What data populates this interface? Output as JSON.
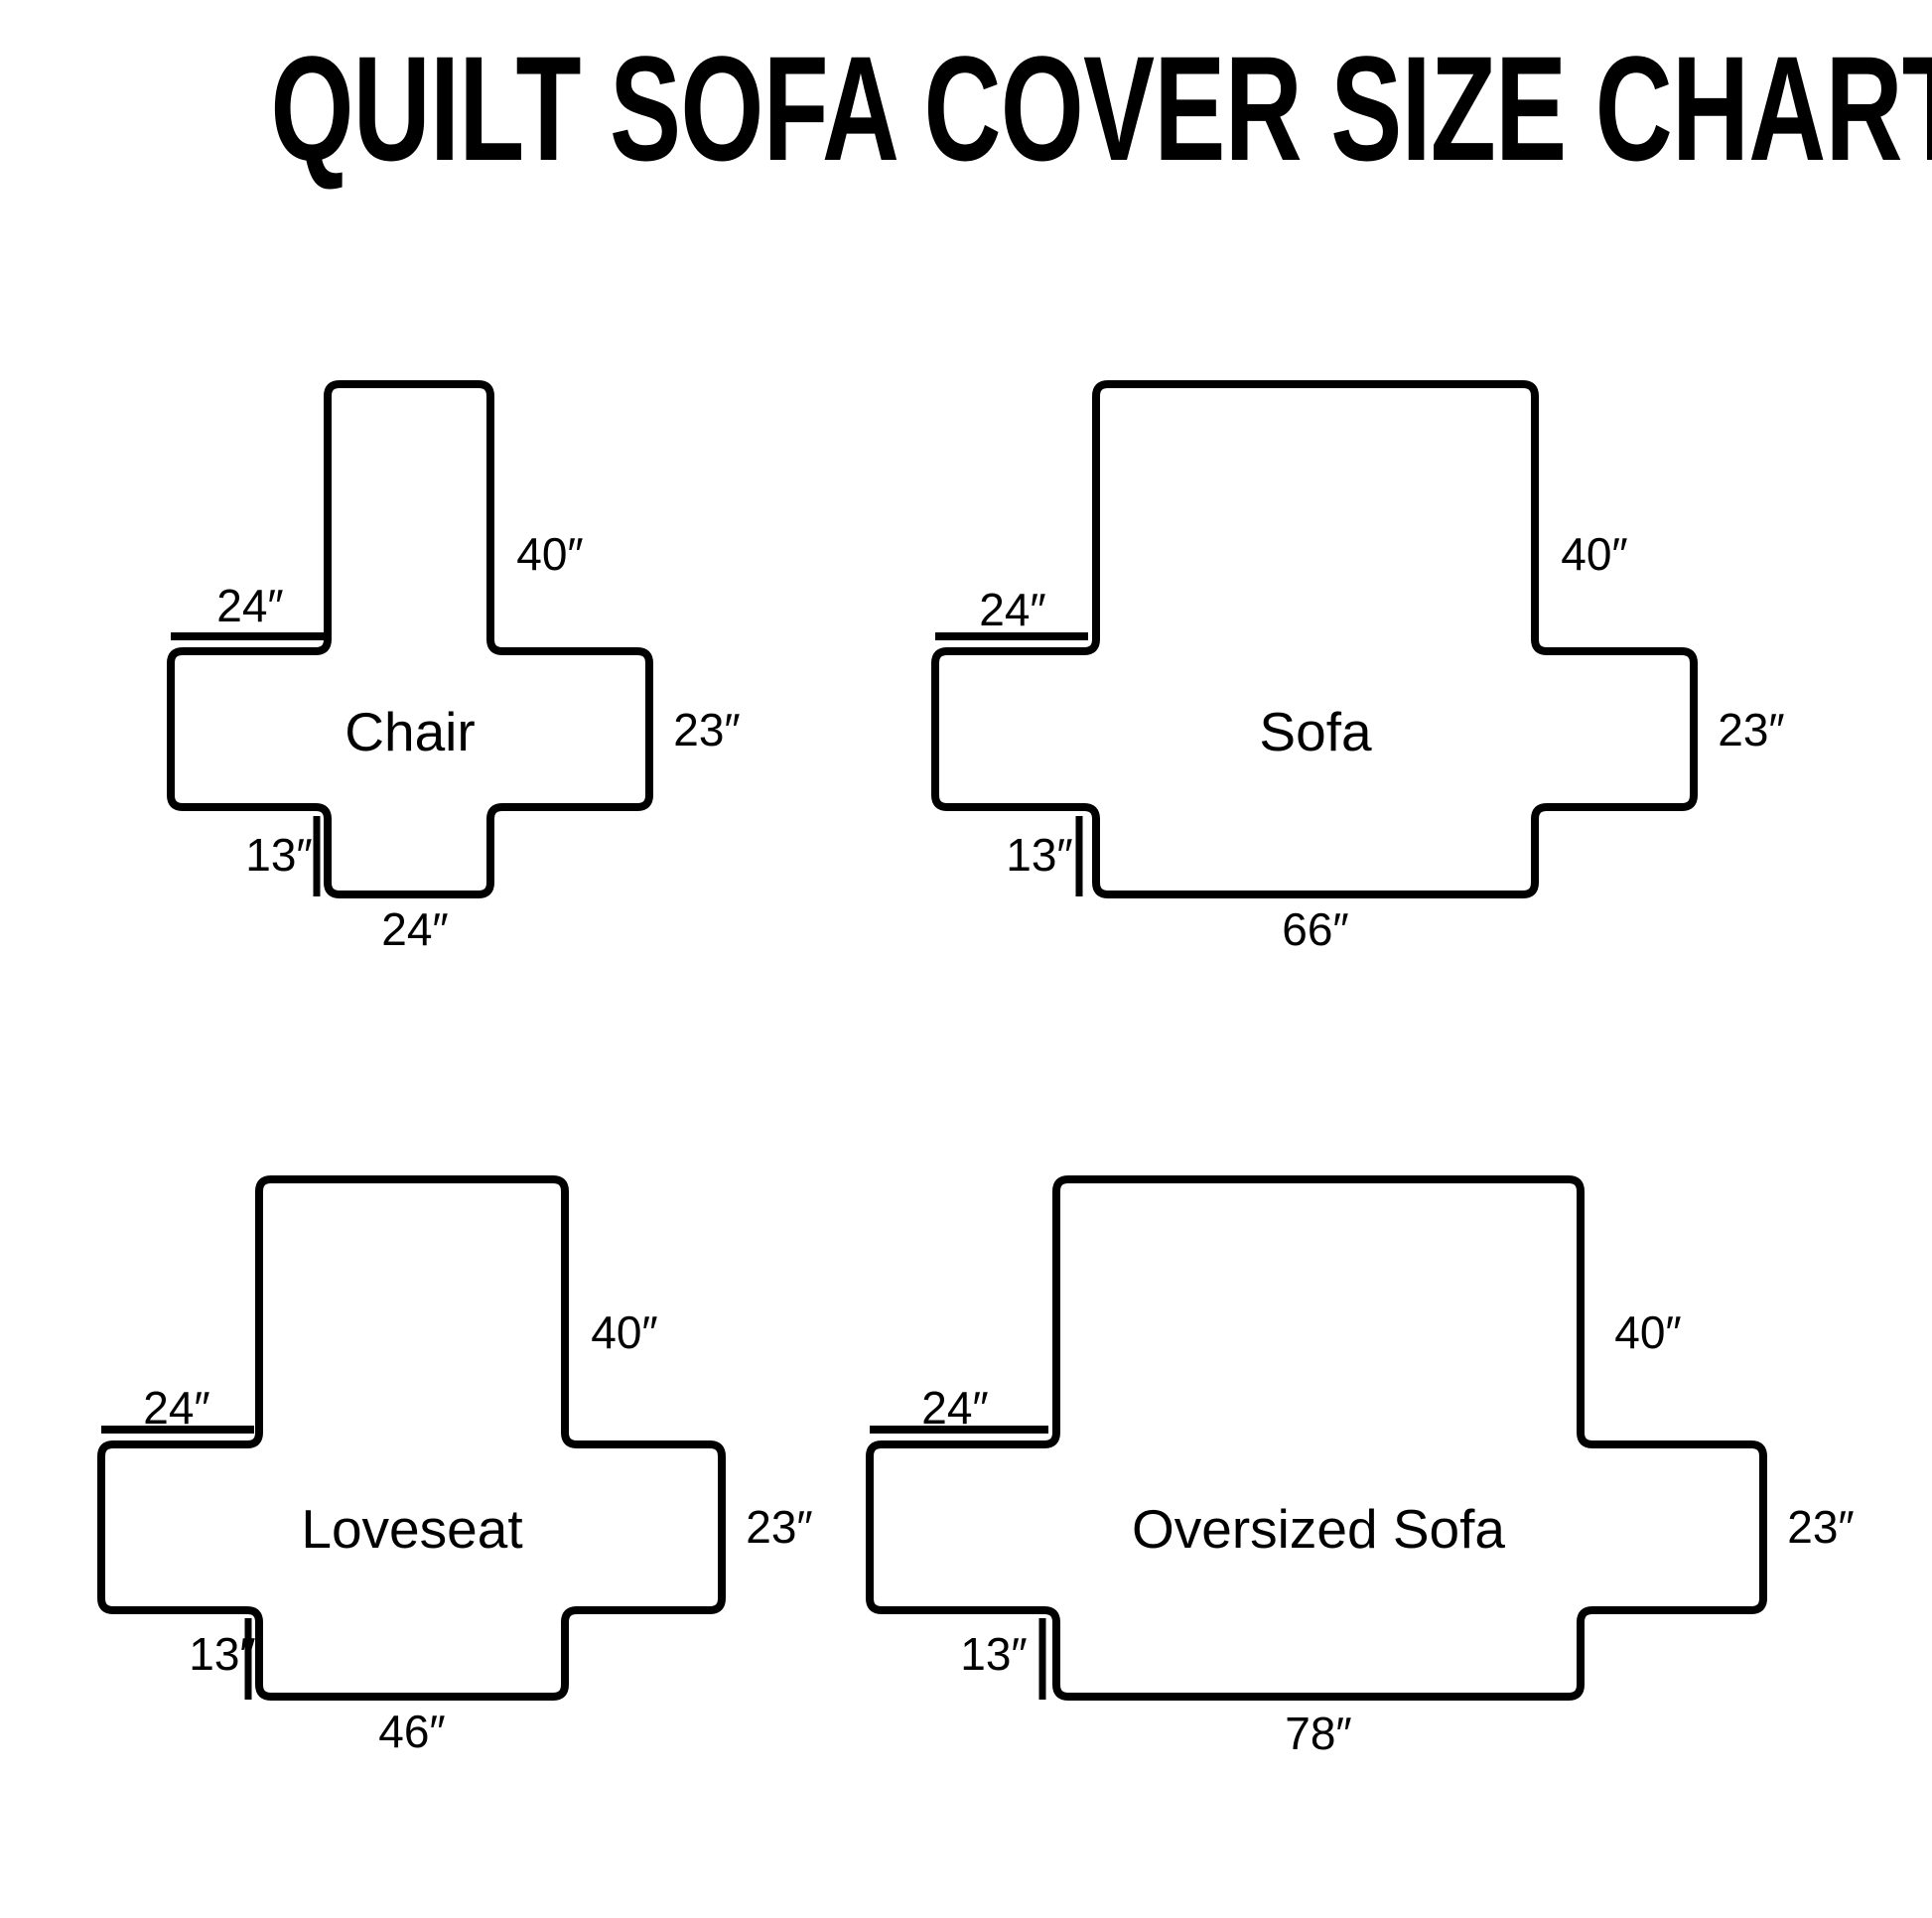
{
  "title": "QUILT SOFA COVER SIZE CHART",
  "diagrams": [
    {
      "name": "Chair",
      "back_height": "40″",
      "arm_top_width": "24″",
      "arm_side_height": "23″",
      "front_drop": "13″",
      "bottom_width": "24″"
    },
    {
      "name": "Sofa",
      "back_height": "40″",
      "arm_top_width": "24″",
      "arm_side_height": "23″",
      "front_drop": "13″",
      "bottom_width": "66″"
    },
    {
      "name": "Loveseat",
      "back_height": "40″",
      "arm_top_width": "24″",
      "arm_side_height": "23″",
      "front_drop": "13″",
      "bottom_width": "46″"
    },
    {
      "name": "Oversized Sofa",
      "back_height": "40″",
      "arm_top_width": "24″",
      "arm_side_height": "23″",
      "front_drop": "13″",
      "bottom_width": "78″"
    }
  ]
}
